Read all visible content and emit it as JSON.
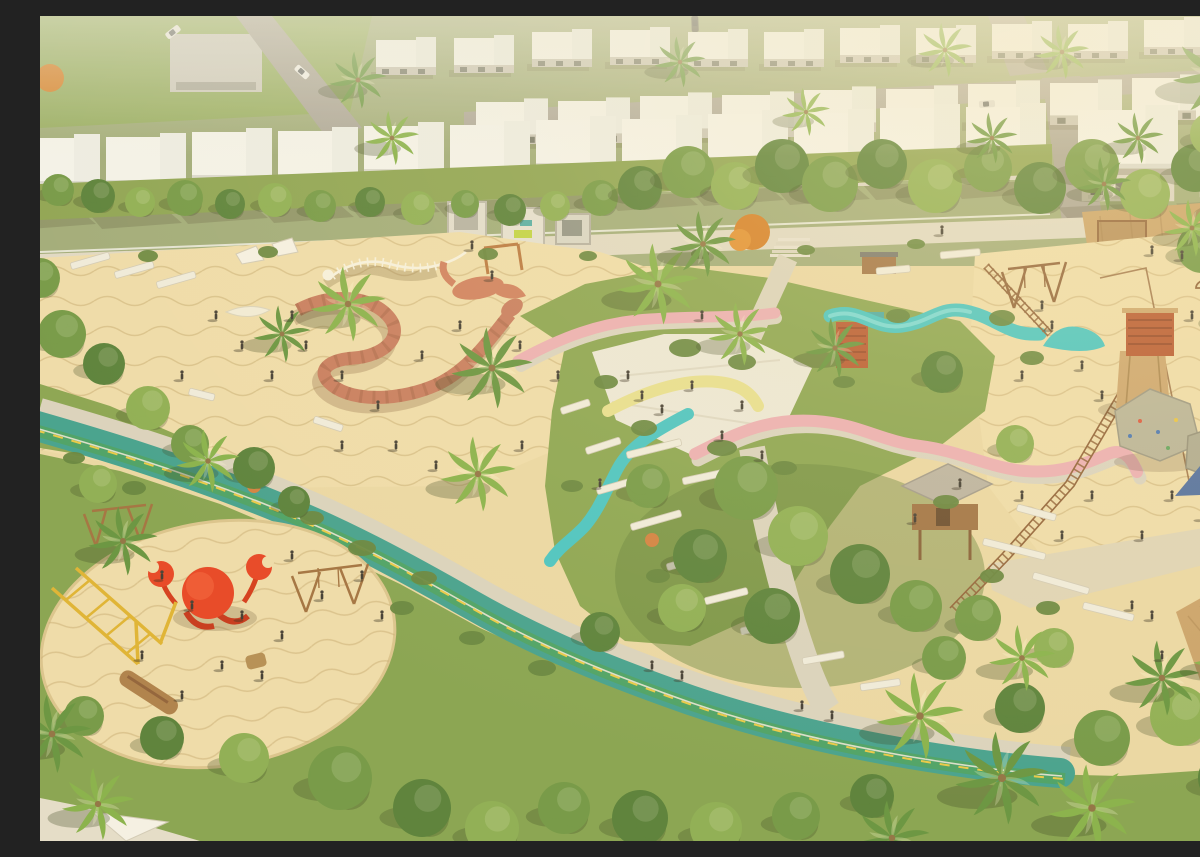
{
  "meta": {
    "description": "Aerial 3D render of a desert community park: sand playgrounds with crab, snake and dinosaur-skeleton play sculptures, winding teal cycle track with green lane and yellow dashes, pink, yellow and turquoise ribbon slides over grass mounds, climbing boulders, wooden tower and tree houses with rope bridges, palm trees, and rows of white flat-roof townhouses along the top."
  },
  "colors": {
    "sand": "#e9d7a4",
    "sandLight": "#eedcab",
    "sandShade": "#d9c28c",
    "ripple": "#c2a56e",
    "grass": "#83a14c",
    "grassLight": "#9ab859",
    "bush": "#5d7f38",
    "treePalette": [
      "#4e7a33",
      "#6a9440",
      "#86ab4e"
    ],
    "palmPalette": [
      "#7fae45",
      "#5d8f39"
    ],
    "path": "#d8d2c0",
    "plaza": "#ebe8db",
    "promenade": "#ded9c8",
    "street": "#a5a198",
    "cycleTeal": "#379d8d",
    "cycleLane": "#3f9e62",
    "laneYellow": "#e9c840",
    "pink": "#eaabb5",
    "yellowSlide": "#e6df8e",
    "tealSlide": "#3cc3c5",
    "coral": "#c4755a",
    "crabRed": "#e63b1c",
    "wood": "#a9743f",
    "woodDark": "#7e5630",
    "deck": "#c79e66",
    "cabinRed": "#b4512b",
    "roofWhite": "#f3f4f1",
    "wallWhite": "#efece1",
    "rock": "#b5b198",
    "bone": "#f6f2e3",
    "frameYellow": "#ddb02c"
  },
  "scene": {
    "houseRows": [
      {
        "symbol": "houseB",
        "x": 336,
        "y": 24,
        "dx": 78,
        "dy": -4,
        "n": 4,
        "s": 1.0
      },
      {
        "symbol": "houseB",
        "x": 648,
        "y": 16,
        "dx": 76,
        "dy": -2,
        "n": 8,
        "s": 1.0
      },
      {
        "symbol": "houseB",
        "x": 436,
        "y": 86,
        "dx": 82,
        "dy": -3,
        "n": 10,
        "s": 1.2
      },
      {
        "symbol": "houseA",
        "x": -20,
        "y": 122,
        "dx": 86,
        "dy": -3,
        "n": 12,
        "s": 1.0
      },
      {
        "symbol": "houseA",
        "x": 1038,
        "y": 94,
        "dx": 118,
        "dy": -6,
        "n": 2,
        "s": 1.25
      }
    ],
    "cars": [
      {
        "x": 133,
        "y": 16,
        "a": -38,
        "c": "#e8e8e6"
      },
      {
        "x": 655,
        "y": 8,
        "a": 88,
        "c": "#50524e"
      },
      {
        "x": 947,
        "y": 88,
        "a": -4,
        "c": "#dcdcda"
      },
      {
        "x": 262,
        "y": 56,
        "a": 42,
        "c": "#f0f0ee"
      }
    ],
    "trees": [
      [
        18,
        174,
        16,
        1
      ],
      [
        58,
        180,
        17,
        0
      ],
      [
        100,
        186,
        15,
        2
      ],
      [
        145,
        182,
        18,
        1
      ],
      [
        190,
        188,
        15,
        0
      ],
      [
        235,
        184,
        17,
        2
      ],
      [
        280,
        190,
        16,
        1
      ],
      [
        330,
        186,
        15,
        0
      ],
      [
        378,
        192,
        17,
        2
      ],
      [
        425,
        188,
        14,
        1
      ],
      [
        470,
        194,
        16,
        0
      ],
      [
        515,
        190,
        15,
        2
      ],
      [
        560,
        182,
        18,
        1
      ],
      [
        600,
        172,
        22,
        0
      ],
      [
        648,
        156,
        26,
        1
      ],
      [
        695,
        170,
        24,
        2
      ],
      [
        742,
        150,
        27,
        0
      ],
      [
        790,
        168,
        28,
        1
      ],
      [
        842,
        148,
        25,
        0
      ],
      [
        895,
        170,
        27,
        2
      ],
      [
        948,
        152,
        24,
        1
      ],
      [
        1000,
        172,
        26,
        0
      ],
      [
        1052,
        150,
        27,
        1
      ],
      [
        1105,
        178,
        25,
        2
      ],
      [
        1155,
        152,
        24,
        0
      ],
      [
        1192,
        190,
        26,
        1
      ],
      [
        22,
        318,
        24,
        1
      ],
      [
        64,
        348,
        21,
        0
      ],
      [
        108,
        392,
        22,
        2
      ],
      [
        150,
        428,
        19,
        1
      ],
      [
        214,
        452,
        21,
        0
      ],
      [
        58,
        468,
        19,
        2
      ],
      [
        0,
        262,
        20,
        1
      ],
      [
        254,
        486,
        16,
        0
      ],
      [
        608,
        470,
        22,
        1
      ],
      [
        660,
        540,
        27,
        0
      ],
      [
        706,
        472,
        32,
        1
      ],
      [
        758,
        520,
        30,
        2
      ],
      [
        820,
        558,
        30,
        0
      ],
      [
        876,
        590,
        26,
        1
      ],
      [
        732,
        600,
        28,
        0
      ],
      [
        642,
        592,
        24,
        2
      ],
      [
        938,
        602,
        23,
        1
      ],
      [
        902,
        356,
        21,
        0
      ],
      [
        975,
        428,
        19,
        2
      ],
      [
        560,
        616,
        20,
        0
      ],
      [
        1162,
        232,
        25,
        1
      ],
      [
        1192,
        300,
        23,
        0
      ],
      [
        1172,
        118,
        22,
        2
      ],
      [
        1196,
        386,
        18,
        1
      ],
      [
        44,
        700,
        20,
        1
      ],
      [
        122,
        722,
        22,
        0
      ],
      [
        204,
        742,
        25,
        2
      ],
      [
        300,
        762,
        32,
        1
      ],
      [
        382,
        792,
        29,
        0
      ],
      [
        452,
        812,
        27,
        2
      ],
      [
        524,
        792,
        26,
        1
      ],
      [
        600,
        802,
        28,
        0
      ],
      [
        676,
        812,
        26,
        2
      ],
      [
        756,
        800,
        24,
        1
      ],
      [
        980,
        692,
        25,
        0
      ],
      [
        1062,
        722,
        28,
        1
      ],
      [
        1140,
        700,
        30,
        2
      ],
      [
        1184,
        762,
        26,
        0
      ],
      [
        904,
        642,
        22,
        1
      ],
      [
        1014,
        632,
        20,
        2
      ],
      [
        832,
        780,
        22,
        0
      ]
    ],
    "bushes": [
      [
        645,
        332,
        16,
        9
      ],
      [
        702,
        346,
        14,
        8
      ],
      [
        604,
        412,
        13,
        8
      ],
      [
        682,
        432,
        15,
        8
      ],
      [
        744,
        452,
        13,
        7
      ],
      [
        962,
        302,
        13,
        8
      ],
      [
        992,
        342,
        12,
        7
      ],
      [
        322,
        532,
        14,
        8
      ],
      [
        384,
        562,
        13,
        7
      ],
      [
        272,
        502,
        12,
        7
      ],
      [
        94,
        472,
        12,
        7
      ],
      [
        34,
        442,
        11,
        6
      ],
      [
        432,
        622,
        13,
        7
      ],
      [
        502,
        652,
        14,
        8
      ],
      [
        362,
        592,
        12,
        7
      ],
      [
        566,
        366,
        12,
        7
      ],
      [
        618,
        560,
        12,
        7
      ],
      [
        532,
        470,
        11,
        6
      ],
      [
        906,
        486,
        13,
        7
      ],
      [
        952,
        560,
        12,
        7
      ],
      [
        1008,
        592,
        12,
        7
      ],
      [
        448,
        238,
        10,
        6
      ],
      [
        228,
        236,
        10,
        6
      ],
      [
        108,
        240,
        10,
        6
      ],
      [
        858,
        300,
        12,
        7
      ],
      [
        804,
        366,
        11,
        6
      ],
      [
        548,
        240,
        9,
        5
      ],
      [
        660,
        238,
        9,
        5
      ],
      [
        766,
        234,
        9,
        5
      ],
      [
        876,
        228,
        9,
        5
      ]
    ],
    "palms": [
      [
        308,
        288,
        1.25,
        0
      ],
      [
        452,
        352,
        1.35,
        1
      ],
      [
        438,
        458,
        1.25,
        0
      ],
      [
        618,
        268,
        1.35,
        0
      ],
      [
        663,
        228,
        1.1,
        1
      ],
      [
        700,
        318,
        1.05,
        0
      ],
      [
        795,
        332,
        1.0,
        1
      ],
      [
        168,
        445,
        1.05,
        0
      ],
      [
        83,
        525,
        1.15,
        1
      ],
      [
        880,
        700,
        1.45,
        0
      ],
      [
        962,
        762,
        1.55,
        1
      ],
      [
        1052,
        792,
        1.45,
        0
      ],
      [
        1122,
        662,
        1.25,
        1
      ],
      [
        982,
        642,
        1.1,
        0
      ],
      [
        852,
        822,
        1.25,
        1
      ],
      [
        1188,
        642,
        1.15,
        0
      ],
      [
        318,
        64,
        0.95,
        1
      ],
      [
        352,
        122,
        0.9,
        0
      ],
      [
        640,
        46,
        0.85,
        1
      ],
      [
        905,
        34,
        0.9,
        0
      ],
      [
        952,
        122,
        0.85,
        1
      ],
      [
        1022,
        36,
        0.9,
        0
      ],
      [
        1098,
        122,
        0.85,
        1
      ],
      [
        766,
        96,
        0.8,
        0
      ],
      [
        1064,
        168,
        0.9,
        1
      ],
      [
        1152,
        212,
        0.95,
        0
      ],
      [
        12,
        718,
        1.3,
        1
      ],
      [
        58,
        788,
        1.2,
        0
      ],
      [
        1178,
        58,
        1.5,
        1
      ],
      [
        242,
        318,
        0.95,
        1
      ]
    ],
    "people": [
      [
        252,
        302
      ],
      [
        266,
        332
      ],
      [
        302,
        362
      ],
      [
        338,
        392
      ],
      [
        382,
        342
      ],
      [
        420,
        312
      ],
      [
        452,
        262
      ],
      [
        480,
        332
      ],
      [
        518,
        362
      ],
      [
        356,
        432
      ],
      [
        396,
        452
      ],
      [
        302,
        432
      ],
      [
        232,
        362
      ],
      [
        202,
        332
      ],
      [
        176,
        302
      ],
      [
        142,
        362
      ],
      [
        482,
        432
      ],
      [
        560,
        470
      ],
      [
        588,
        362
      ],
      [
        602,
        382
      ],
      [
        622,
        396
      ],
      [
        652,
        372
      ],
      [
        702,
        392
      ],
      [
        662,
        302
      ],
      [
        682,
        422
      ],
      [
        722,
        442
      ],
      [
        612,
        652
      ],
      [
        642,
        662
      ],
      [
        762,
        692
      ],
      [
        792,
        702
      ],
      [
        1092,
        592
      ],
      [
        1112,
        602
      ],
      [
        1122,
        642
      ],
      [
        1002,
        292
      ],
      [
        1012,
        312
      ],
      [
        1042,
        352
      ],
      [
        1062,
        382
      ],
      [
        982,
        362
      ],
      [
        1152,
        302
      ],
      [
        1172,
        342
      ],
      [
        1192,
        392
      ],
      [
        1132,
        482
      ],
      [
        1162,
        502
      ],
      [
        1102,
        522
      ],
      [
        1052,
        482
      ],
      [
        982,
        482
      ],
      [
        1022,
        522
      ],
      [
        122,
        562
      ],
      [
        152,
        592
      ],
      [
        202,
        602
      ],
      [
        242,
        622
      ],
      [
        282,
        582
      ],
      [
        182,
        652
      ],
      [
        222,
        662
      ],
      [
        142,
        682
      ],
      [
        102,
        642
      ],
      [
        322,
        562
      ],
      [
        342,
        602
      ],
      [
        252,
        542
      ],
      [
        432,
        232
      ],
      [
        902,
        217
      ],
      [
        1112,
        237
      ],
      [
        1142,
        242
      ],
      [
        875,
        505
      ],
      [
        920,
        470
      ]
    ],
    "walls": [
      [
        275,
        400,
        18,
        30
      ],
      [
        150,
        372,
        14,
        26
      ],
      [
        586,
        436,
        -14,
        56
      ],
      [
        642,
        462,
        -12,
        50
      ],
      [
        944,
        522,
        14,
        64
      ],
      [
        994,
        556,
        16,
        58
      ],
      [
        1044,
        586,
        14,
        52
      ],
      [
        556,
        472,
        -16,
        46
      ],
      [
        590,
        508,
        -16,
        52
      ],
      [
        626,
        548,
        -16,
        48
      ],
      [
        664,
        582,
        -14,
        44
      ],
      [
        700,
        612,
        -12,
        40
      ],
      [
        762,
        642,
        -10,
        42
      ],
      [
        820,
        668,
        -8,
        40
      ],
      [
        545,
        432,
        -18,
        36
      ],
      [
        520,
        392,
        -18,
        30
      ],
      [
        978,
        488,
        15,
        40
      ],
      [
        900,
        236,
        -5,
        40
      ],
      [
        836,
        252,
        -5,
        34
      ],
      [
        30,
        247,
        -16,
        40
      ],
      [
        74,
        256,
        -16,
        40
      ],
      [
        116,
        266,
        -16,
        40
      ]
    ]
  }
}
